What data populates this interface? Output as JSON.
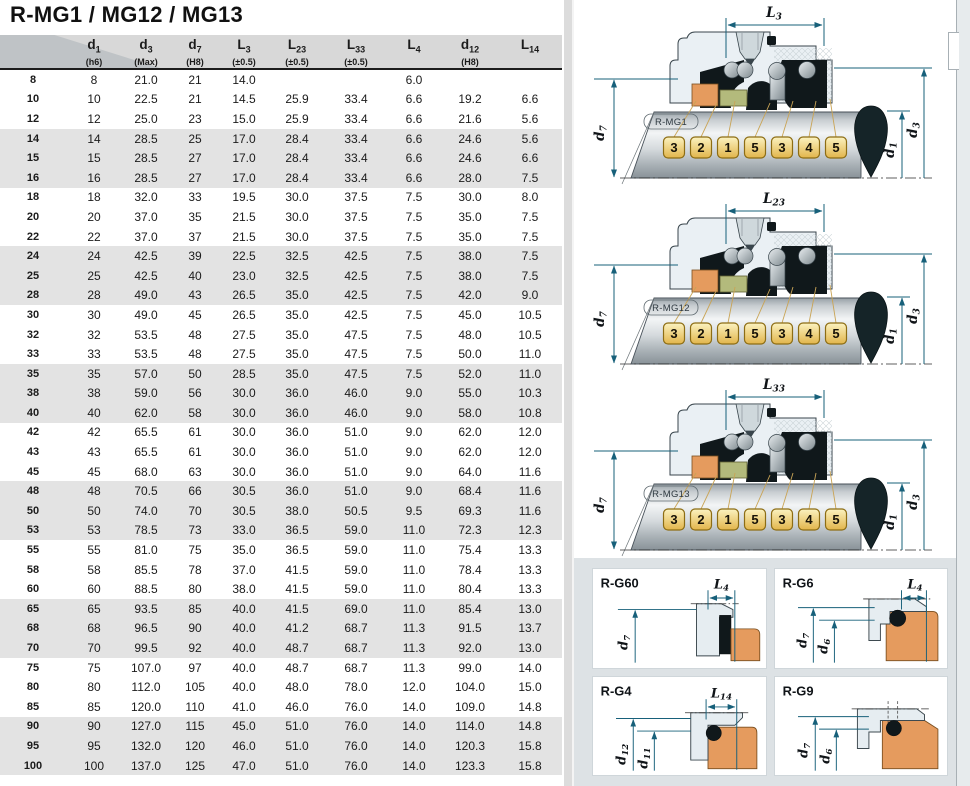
{
  "title": "R-MG1 / MG12 / MG13",
  "colors": {
    "accent_dim_lines": "#17607a",
    "callout_fill": "#f2d98c",
    "callout_border": "#8d6d14",
    "orange_part": "#e59b5e",
    "olive_part": "#b3ba7c",
    "header_bg": "#d8d8d8",
    "band_bg": "#e3e3e3"
  },
  "table": {
    "headers": [
      {
        "sym": "",
        "sub": "",
        "tol": ""
      },
      {
        "sym": "d",
        "sub": "1",
        "tol": "(h6)"
      },
      {
        "sym": "d",
        "sub": "3",
        "tol": "(Max)"
      },
      {
        "sym": "d",
        "sub": "7",
        "tol": "(H8)"
      },
      {
        "sym": "L",
        "sub": "3",
        "tol": "(±0.5)"
      },
      {
        "sym": "L",
        "sub": "23",
        "tol": "(±0.5)"
      },
      {
        "sym": "L",
        "sub": "33",
        "tol": "(±0.5)"
      },
      {
        "sym": "L",
        "sub": "4",
        "tol": ""
      },
      {
        "sym": "d",
        "sub": "12",
        "tol": "(H8)"
      },
      {
        "sym": "L",
        "sub": "14",
        "tol": ""
      }
    ],
    "rows": [
      {
        "size": "8",
        "values": [
          "8",
          "21.0",
          "21",
          "14.0",
          "",
          "",
          "6.0",
          "",
          ""
        ]
      },
      {
        "size": "10",
        "values": [
          "10",
          "22.5",
          "21",
          "14.5",
          "25.9",
          "33.4",
          "6.6",
          "19.2",
          "6.6"
        ]
      },
      {
        "size": "12",
        "values": [
          "12",
          "25.0",
          "23",
          "15.0",
          "25.9",
          "33.4",
          "6.6",
          "21.6",
          "5.6"
        ]
      },
      {
        "size": "14",
        "values": [
          "14",
          "28.5",
          "25",
          "17.0",
          "28.4",
          "33.4",
          "6.6",
          "24.6",
          "5.6"
        ]
      },
      {
        "size": "15",
        "values": [
          "15",
          "28.5",
          "27",
          "17.0",
          "28.4",
          "33.4",
          "6.6",
          "24.6",
          "6.6"
        ]
      },
      {
        "size": "16",
        "values": [
          "16",
          "28.5",
          "27",
          "17.0",
          "28.4",
          "33.4",
          "6.6",
          "28.0",
          "7.5"
        ]
      },
      {
        "size": "18",
        "values": [
          "18",
          "32.0",
          "33",
          "19.5",
          "30.0",
          "37.5",
          "7.5",
          "30.0",
          "8.0"
        ]
      },
      {
        "size": "20",
        "values": [
          "20",
          "37.0",
          "35",
          "21.5",
          "30.0",
          "37.5",
          "7.5",
          "35.0",
          "7.5"
        ]
      },
      {
        "size": "22",
        "values": [
          "22",
          "37.0",
          "37",
          "21.5",
          "30.0",
          "37.5",
          "7.5",
          "35.0",
          "7.5"
        ]
      },
      {
        "size": "24",
        "values": [
          "24",
          "42.5",
          "39",
          "22.5",
          "32.5",
          "42.5",
          "7.5",
          "38.0",
          "7.5"
        ]
      },
      {
        "size": "25",
        "values": [
          "25",
          "42.5",
          "40",
          "23.0",
          "32.5",
          "42.5",
          "7.5",
          "38.0",
          "7.5"
        ]
      },
      {
        "size": "28",
        "values": [
          "28",
          "49.0",
          "43",
          "26.5",
          "35.0",
          "42.5",
          "7.5",
          "42.0",
          "9.0"
        ]
      },
      {
        "size": "30",
        "values": [
          "30",
          "49.0",
          "45",
          "26.5",
          "35.0",
          "42.5",
          "7.5",
          "45.0",
          "10.5"
        ]
      },
      {
        "size": "32",
        "values": [
          "32",
          "53.5",
          "48",
          "27.5",
          "35.0",
          "47.5",
          "7.5",
          "48.0",
          "10.5"
        ]
      },
      {
        "size": "33",
        "values": [
          "33",
          "53.5",
          "48",
          "27.5",
          "35.0",
          "47.5",
          "7.5",
          "50.0",
          "11.0"
        ]
      },
      {
        "size": "35",
        "values": [
          "35",
          "57.0",
          "50",
          "28.5",
          "35.0",
          "47.5",
          "7.5",
          "52.0",
          "11.0"
        ]
      },
      {
        "size": "38",
        "values": [
          "38",
          "59.0",
          "56",
          "30.0",
          "36.0",
          "46.0",
          "9.0",
          "55.0",
          "10.3"
        ]
      },
      {
        "size": "40",
        "values": [
          "40",
          "62.0",
          "58",
          "30.0",
          "36.0",
          "46.0",
          "9.0",
          "58.0",
          "10.8"
        ]
      },
      {
        "size": "42",
        "values": [
          "42",
          "65.5",
          "61",
          "30.0",
          "36.0",
          "51.0",
          "9.0",
          "62.0",
          "12.0"
        ]
      },
      {
        "size": "43",
        "values": [
          "43",
          "65.5",
          "61",
          "30.0",
          "36.0",
          "51.0",
          "9.0",
          "62.0",
          "12.0"
        ]
      },
      {
        "size": "45",
        "values": [
          "45",
          "68.0",
          "63",
          "30.0",
          "36.0",
          "51.0",
          "9.0",
          "64.0",
          "11.6"
        ]
      },
      {
        "size": "48",
        "values": [
          "48",
          "70.5",
          "66",
          "30.5",
          "36.0",
          "51.0",
          "9.0",
          "68.4",
          "11.6"
        ]
      },
      {
        "size": "50",
        "values": [
          "50",
          "74.0",
          "70",
          "30.5",
          "38.0",
          "50.5",
          "9.5",
          "69.3",
          "11.6"
        ]
      },
      {
        "size": "53",
        "values": [
          "53",
          "78.5",
          "73",
          "33.0",
          "36.5",
          "59.0",
          "11.0",
          "72.3",
          "12.3"
        ]
      },
      {
        "size": "55",
        "values": [
          "55",
          "81.0",
          "75",
          "35.0",
          "36.5",
          "59.0",
          "11.0",
          "75.4",
          "13.3"
        ]
      },
      {
        "size": "58",
        "values": [
          "58",
          "85.5",
          "78",
          "37.0",
          "41.5",
          "59.0",
          "11.0",
          "78.4",
          "13.3"
        ]
      },
      {
        "size": "60",
        "values": [
          "60",
          "88.5",
          "80",
          "38.0",
          "41.5",
          "59.0",
          "11.0",
          "80.4",
          "13.3"
        ]
      },
      {
        "size": "65",
        "values": [
          "65",
          "93.5",
          "85",
          "40.0",
          "41.5",
          "69.0",
          "11.0",
          "85.4",
          "13.0"
        ]
      },
      {
        "size": "68",
        "values": [
          "68",
          "96.5",
          "90",
          "40.0",
          "41.2",
          "68.7",
          "11.3",
          "91.5",
          "13.7"
        ]
      },
      {
        "size": "70",
        "values": [
          "70",
          "99.5",
          "92",
          "40.0",
          "48.7",
          "68.7",
          "11.3",
          "92.0",
          "13.0"
        ]
      },
      {
        "size": "75",
        "values": [
          "75",
          "107.0",
          "97",
          "40.0",
          "48.7",
          "68.7",
          "11.3",
          "99.0",
          "14.0"
        ]
      },
      {
        "size": "80",
        "values": [
          "80",
          "112.0",
          "105",
          "40.0",
          "48.0",
          "78.0",
          "12.0",
          "104.0",
          "15.0"
        ]
      },
      {
        "size": "85",
        "values": [
          "85",
          "120.0",
          "110",
          "41.0",
          "46.0",
          "76.0",
          "14.0",
          "109.0",
          "14.8"
        ]
      },
      {
        "size": "90",
        "values": [
          "90",
          "127.0",
          "115",
          "45.0",
          "51.0",
          "76.0",
          "14.0",
          "114.0",
          "14.8"
        ]
      },
      {
        "size": "95",
        "values": [
          "95",
          "132.0",
          "120",
          "46.0",
          "51.0",
          "76.0",
          "14.0",
          "120.3",
          "15.8"
        ]
      },
      {
        "size": "100",
        "values": [
          "100",
          "137.0",
          "125",
          "47.0",
          "51.0",
          "76.0",
          "14.0",
          "123.3",
          "15.8"
        ]
      }
    ]
  },
  "diagrams": {
    "main": [
      {
        "label": "R-MG1",
        "dim": {
          "sym": "L",
          "sub": "3"
        },
        "left_dim": {
          "sym": "d",
          "sub": "7"
        },
        "right_dims": [
          {
            "sym": "d",
            "sub": "1"
          },
          {
            "sym": "d",
            "sub": "3"
          }
        ],
        "callouts": [
          "3",
          "2",
          "1",
          "5",
          "3",
          "4",
          "5"
        ]
      },
      {
        "label": "R-MG12",
        "dim": {
          "sym": "L",
          "sub": "23"
        },
        "left_dim": {
          "sym": "d",
          "sub": "7"
        },
        "right_dims": [
          {
            "sym": "d",
            "sub": "1"
          },
          {
            "sym": "d",
            "sub": "3"
          }
        ],
        "callouts": [
          "3",
          "2",
          "1",
          "5",
          "3",
          "4",
          "5"
        ]
      },
      {
        "label": "R-MG13",
        "dim": {
          "sym": "L",
          "sub": "33"
        },
        "left_dim": {
          "sym": "d",
          "sub": "7"
        },
        "right_dims": [
          {
            "sym": "d",
            "sub": "1"
          },
          {
            "sym": "d",
            "sub": "3"
          }
        ],
        "callouts": [
          "3",
          "2",
          "1",
          "5",
          "3",
          "4",
          "5"
        ]
      }
    ],
    "small": [
      {
        "label": "R-G60",
        "top": {
          "sym": "L",
          "sub": "4"
        },
        "dims": [
          {
            "sym": "d",
            "sub": "7"
          }
        ]
      },
      {
        "label": "R-G6",
        "top": {
          "sym": "L",
          "sub": "4"
        },
        "dims": [
          {
            "sym": "d",
            "sub": "7"
          },
          {
            "sym": "d",
            "sub": "6"
          }
        ]
      },
      {
        "label": "R-G4",
        "top": {
          "sym": "L",
          "sub": "14"
        },
        "dims": [
          {
            "sym": "d",
            "sub": "12"
          },
          {
            "sym": "d",
            "sub": "11"
          }
        ]
      },
      {
        "label": "R-G9",
        "dims": [
          {
            "sym": "d",
            "sub": "7"
          },
          {
            "sym": "d",
            "sub": "6"
          }
        ]
      }
    ]
  }
}
